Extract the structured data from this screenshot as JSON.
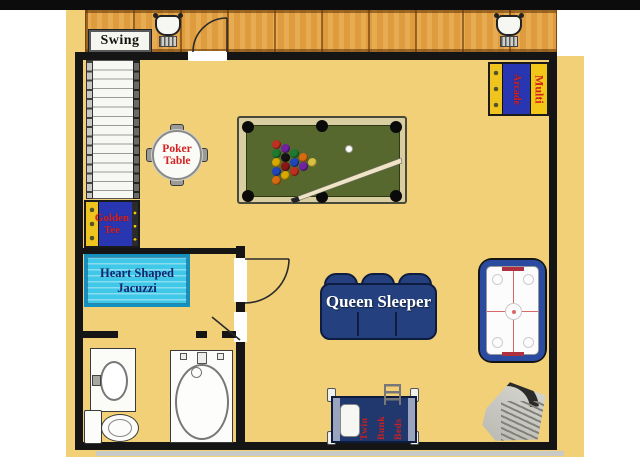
{
  "colors": {
    "paper_yellow": "#F1D077",
    "wall_black": "#151515",
    "deck_wood": "#DE9C3E",
    "jacuzzi_cyan": "#3FC8E8",
    "navy_furniture": "#24407E",
    "pool_felt": "#57682E",
    "pool_frame_tan": "#D8CEA2",
    "machine_blue": "#2936B2",
    "machine_yellow": "#EFC41E",
    "label_red": "#D42222",
    "air_hockey_blue": "#2B4BA0",
    "fixture_white": "#FCFCFA"
  },
  "labels": {
    "swing": "Swing",
    "poker_line1": "Poker",
    "poker_line2": "Table",
    "golden_tee_line1": "Golden",
    "golden_tee_line2": "Tee",
    "jacuzzi_line1": "Heart Shaped",
    "jacuzzi_line2": "Jacuzzi",
    "queen_sleeper": "Queen Sleeper",
    "arcade_vertical": "Arcade",
    "multi_vertical": "Multi",
    "bunk_col1": "Twin",
    "bunk_col2": "Bunk",
    "bunk_col3": "Beds"
  },
  "pool_balls": [
    "#C03020",
    "#1E7A2E",
    "#D8A800",
    "#2244BB",
    "#D86A10",
    "#7022A0",
    "#141414",
    "#8A1616",
    "#D8A800",
    "#1E7A2E",
    "#2244BB",
    "#C03020",
    "#D86A10",
    "#7022A0",
    "#D8C040"
  ],
  "features": [
    "deck",
    "porch-swings",
    "staircase",
    "poker-table",
    "pool-table",
    "multi-arcade-game",
    "golden-tee-arcade",
    "heart-shaped-jacuzzi",
    "queen-sleeper-sofa",
    "air-hockey-table",
    "twin-bunk-beds",
    "bathroom-vanity-sink",
    "bathtub",
    "toilet",
    "corner-fireplace"
  ]
}
